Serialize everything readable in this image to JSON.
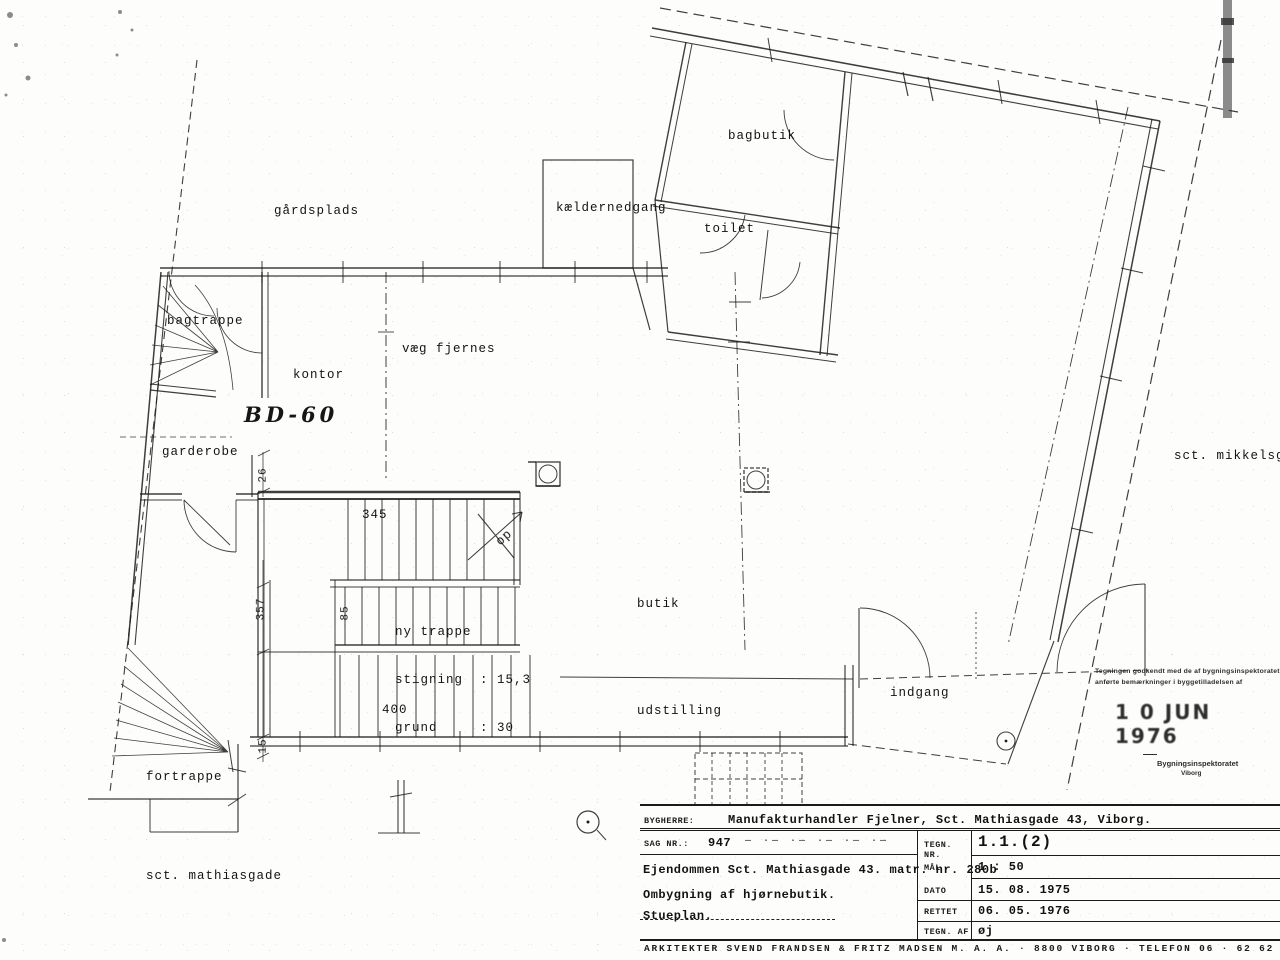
{
  "rooms": {
    "gaardsplads": "gårdsplads",
    "kaeldernedgang": "kældernedgang",
    "bagbutik": "bagbutik",
    "toilet": "toilet",
    "bagtrappe": "bagtrappe",
    "kontor": "kontor",
    "vaeg_fjernes": "væg fjernes",
    "bd60": "BD-60",
    "garderobe": "garderobe",
    "butik": "butik",
    "udstilling": "udstilling",
    "indgang": "indgang",
    "fortrappe": "fortrappe",
    "sct_mathiasgade": "sct. mathiasgade",
    "sct_mikkelsgade": "sct. mikkelsga",
    "op": "op"
  },
  "dimensions": {
    "d345": "345",
    "d400": "400",
    "d357": "357",
    "d85": "85",
    "d26": "26",
    "d15": "15"
  },
  "stair_note": {
    "line1": "ny trappe",
    "line2": "stigning  : 15,3",
    "line3": "grund     : 30"
  },
  "stamp": {
    "line1": "Tegningen godkendt med de af bygningsinspektoratet",
    "line2": "anførte bemærkninger i byggetilladelsen af",
    "date": "1 0 JUN 1976",
    "office": "Bygningsinspektoratet",
    "city": "Viborg"
  },
  "title_block": {
    "bygherre_label": "BYGHERRE:",
    "bygherre_value": "Manufakturhandler Fjelner, Sct. Mathiasgade 43, Viborg.",
    "sag_label": "SAG NR.:",
    "sag_value": "947",
    "sag_filler": "— ·— ·— ·— ·— ·—",
    "tegn_nr_label": "TEGN. NR.",
    "tegn_nr_value": "1.1.(2)",
    "maal_label": "MÅL",
    "maal_value": "1 : 50",
    "dato_label": "DATO",
    "dato_value": "15. 08. 1975",
    "rettet_label": "RETTET",
    "rettet_value": "06. 05. 1976",
    "tegn_af_label": "TEGN. AF",
    "tegn_af_value": "øj",
    "project_line1": "Ejendommen Sct. Mathiasgade 43. matr. nr. 280b",
    "project_line2": "Ombygning af hjørnebutik.",
    "project_line3": "Stueplan.",
    "footer": "ARKITEKTER SVEND FRANDSEN & FRITZ MADSEN M. A. A. · 8800 VIBORG · TELEFON 06 · 62 62"
  }
}
